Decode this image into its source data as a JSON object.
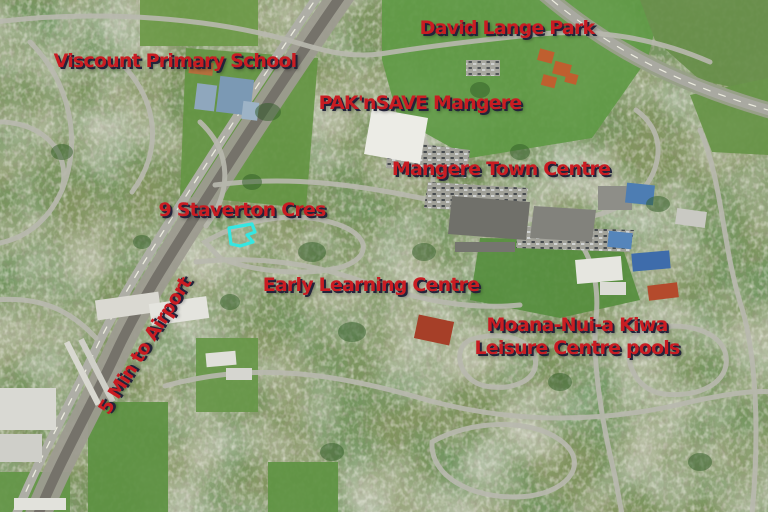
{
  "map": {
    "accent_text_color": "#c91c22",
    "label_shadow_color": "#23233a",
    "highlight": {
      "name": "property-boundary-highlight",
      "color": "#35e7e2"
    },
    "labels": {
      "viscount": "Viscount Primary School",
      "david_lange": "David Lange Park",
      "paknsave": "PAK'nSAVE Mangere",
      "town_centre": "Mangere Town Centre",
      "staverton": "9 Staverton Cres",
      "early_learning": "Early Learning Centre",
      "leisure_line1": "Moana-Nui-a Kiwa",
      "leisure_line2": "Leisure Centre pools",
      "airport": "5 Min to Airport"
    }
  }
}
